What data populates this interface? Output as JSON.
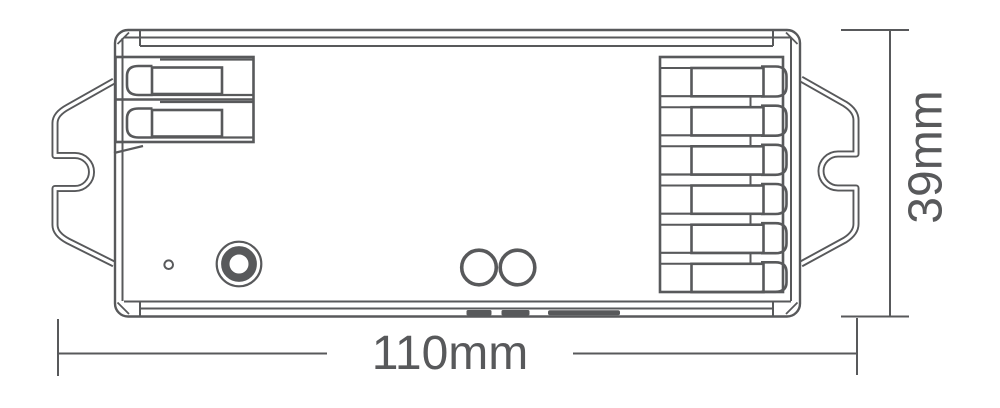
{
  "dimension_labels": {
    "width": "110mm",
    "height": "39mm"
  },
  "colors": {
    "line": "#58595b",
    "label_text": "#58595b",
    "background": "#ffffff"
  }
}
